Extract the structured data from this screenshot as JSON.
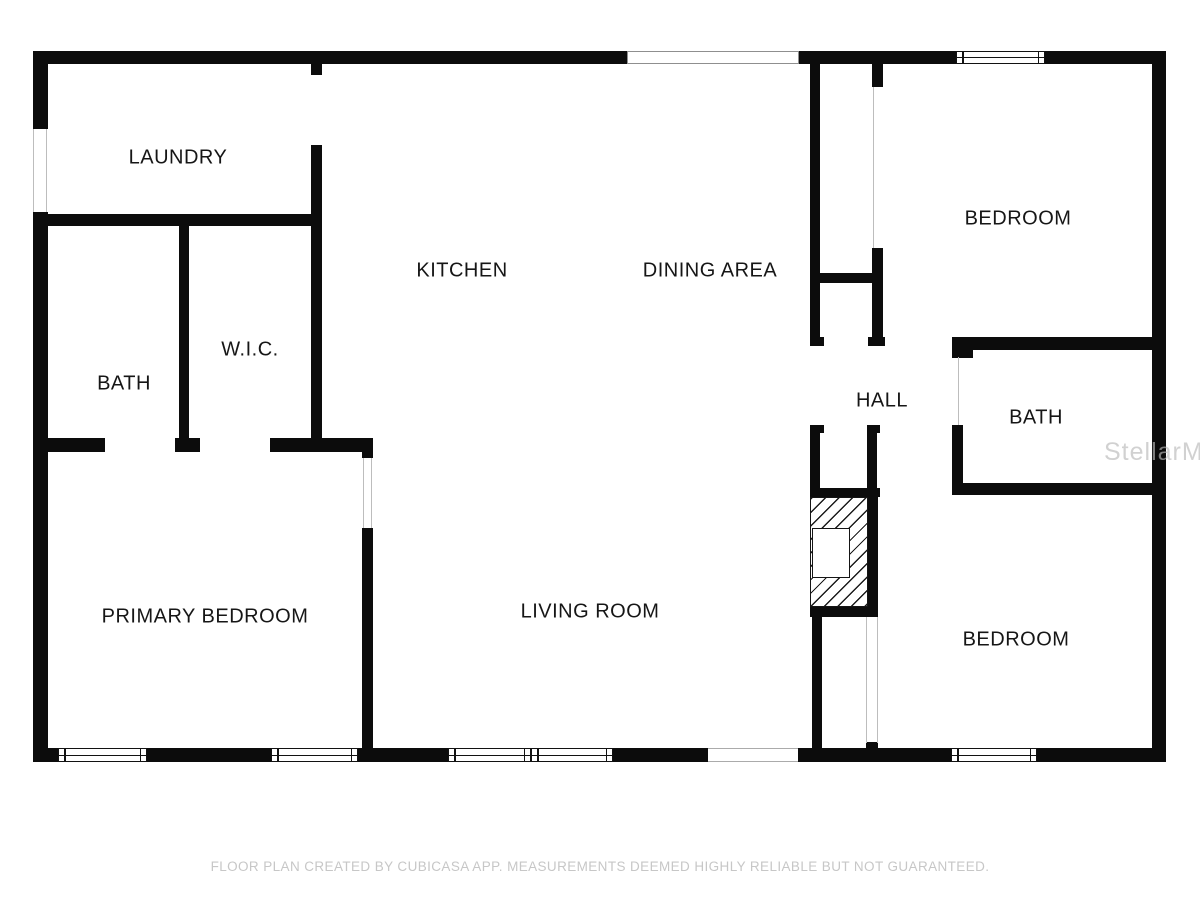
{
  "floorplan": {
    "canvas": {
      "width": 1200,
      "height": 900,
      "background": "#ffffff",
      "wall_color": "#0c0c0c"
    },
    "caption": {
      "text": "FLOOR PLAN CREATED BY CUBICASA APP. MEASUREMENTS DEEMED HIGHLY RELIABLE BUT NOT GUARANTEED.",
      "top": 859
    },
    "watermark": {
      "text": "StellarMLS",
      "left": 1104,
      "top": 438
    },
    "rooms": [
      {
        "id": "laundry",
        "label": "LAUNDRY",
        "x": 178,
        "y": 158
      },
      {
        "id": "kitchen",
        "label": "KITCHEN",
        "x": 462,
        "y": 271
      },
      {
        "id": "dining-area",
        "label": "DINING AREA",
        "x": 710,
        "y": 271
      },
      {
        "id": "bedroom-top",
        "label": "BEDROOM",
        "x": 1018,
        "y": 219
      },
      {
        "id": "bath-left",
        "label": "BATH",
        "x": 124,
        "y": 384
      },
      {
        "id": "wic",
        "label": "W.I.C.",
        "x": 250,
        "y": 350
      },
      {
        "id": "hall",
        "label": "HALL",
        "x": 882,
        "y": 401
      },
      {
        "id": "bath-right",
        "label": "BATH",
        "x": 1036,
        "y": 418
      },
      {
        "id": "primary-bedroom",
        "label": "PRIMARY BEDROOM",
        "x": 205,
        "y": 617
      },
      {
        "id": "living-room",
        "label": "LIVING ROOM",
        "x": 590,
        "y": 612
      },
      {
        "id": "bedroom-bottom",
        "label": "BEDROOM",
        "x": 1016,
        "y": 640
      }
    ],
    "walls": [
      {
        "id": "outer-top-left",
        "x": 33,
        "y": 51,
        "w": 594,
        "h": 13
      },
      {
        "id": "outer-top-right-a",
        "x": 799,
        "y": 51,
        "w": 157,
        "h": 13
      },
      {
        "id": "outer-top-right-b",
        "x": 1045,
        "y": 51,
        "w": 121,
        "h": 13
      },
      {
        "id": "outer-left-upper",
        "x": 33,
        "y": 51,
        "w": 15,
        "h": 78
      },
      {
        "id": "outer-left-lower",
        "x": 33,
        "y": 212,
        "w": 15,
        "h": 550
      },
      {
        "id": "outer-right",
        "x": 1152,
        "y": 51,
        "w": 14,
        "h": 711
      },
      {
        "id": "outer-bottom-1",
        "x": 33,
        "y": 748,
        "w": 25,
        "h": 14
      },
      {
        "id": "outer-bottom-2",
        "x": 147,
        "y": 748,
        "w": 124,
        "h": 14
      },
      {
        "id": "outer-bottom-3",
        "x": 358,
        "y": 748,
        "w": 90,
        "h": 14
      },
      {
        "id": "outer-bottom-4",
        "x": 613,
        "y": 748,
        "w": 95,
        "h": 14
      },
      {
        "id": "outer-bottom-5",
        "x": 798,
        "y": 748,
        "w": 153,
        "h": 14
      },
      {
        "id": "outer-bottom-6",
        "x": 1037,
        "y": 748,
        "w": 129,
        "h": 14
      },
      {
        "id": "laundry-right-upper",
        "x": 311,
        "y": 64,
        "w": 11,
        "h": 11
      },
      {
        "id": "laundry-wic-right",
        "x": 311,
        "y": 145,
        "w": 11,
        "h": 293
      },
      {
        "id": "laundry-bottom",
        "x": 33,
        "y": 214,
        "w": 288,
        "h": 12
      },
      {
        "id": "bath-wic-divider",
        "x": 179,
        "y": 226,
        "w": 10,
        "h": 214
      },
      {
        "id": "bathwic-bottom-left",
        "x": 33,
        "y": 438,
        "w": 72,
        "h": 14
      },
      {
        "id": "bathwic-bottom-mid",
        "x": 175,
        "y": 438,
        "w": 25,
        "h": 14
      },
      {
        "id": "bathwic-bottom-right",
        "x": 270,
        "y": 438,
        "w": 102,
        "h": 14
      },
      {
        "id": "lr-divider-stub",
        "x": 362,
        "y": 438,
        "w": 11,
        "h": 20
      },
      {
        "id": "lr-divider-main",
        "x": 362,
        "y": 528,
        "w": 11,
        "h": 220
      },
      {
        "id": "dining-hall-wall",
        "x": 810,
        "y": 64,
        "w": 10,
        "h": 282
      },
      {
        "id": "closet-divider",
        "x": 810,
        "y": 273,
        "w": 73,
        "h": 10
      },
      {
        "id": "closet-right-upper",
        "x": 872,
        "y": 64,
        "w": 11,
        "h": 23
      },
      {
        "id": "closet-right-lower",
        "x": 872,
        "y": 248,
        "w": 11,
        "h": 98
      },
      {
        "id": "closet-foot-left",
        "x": 810,
        "y": 337,
        "w": 14,
        "h": 9
      },
      {
        "id": "closet-foot-right",
        "x": 868,
        "y": 337,
        "w": 17,
        "h": 9
      },
      {
        "id": "bath2-top",
        "x": 952,
        "y": 337,
        "w": 214,
        "h": 13
      },
      {
        "id": "bath2-left-stub",
        "x": 952,
        "y": 350,
        "w": 21,
        "h": 8
      },
      {
        "id": "bath2-left",
        "x": 952,
        "y": 425,
        "w": 11,
        "h": 62
      },
      {
        "id": "bath2-bottom",
        "x": 952,
        "y": 483,
        "w": 214,
        "h": 12
      },
      {
        "id": "niche-left",
        "x": 810,
        "y": 425,
        "w": 10,
        "h": 67
      },
      {
        "id": "niche-left-foot",
        "x": 810,
        "y": 425,
        "w": 14,
        "h": 8
      },
      {
        "id": "niche-right",
        "x": 867,
        "y": 425,
        "w": 10,
        "h": 67
      },
      {
        "id": "niche-right-foot",
        "x": 867,
        "y": 425,
        "w": 13,
        "h": 8
      },
      {
        "id": "niche-bottom",
        "x": 810,
        "y": 488,
        "w": 70,
        "h": 9
      },
      {
        "id": "fireplace-right",
        "x": 868,
        "y": 497,
        "w": 10,
        "h": 110
      },
      {
        "id": "fireplace-bottom",
        "x": 810,
        "y": 607,
        "w": 68,
        "h": 10
      },
      {
        "id": "below-fireplace",
        "x": 812,
        "y": 617,
        "w": 10,
        "h": 131
      },
      {
        "id": "closet2-stub",
        "x": 866,
        "y": 742,
        "w": 12,
        "h": 6
      }
    ],
    "windows": [
      {
        "id": "window-top",
        "x": 956,
        "y": 51,
        "w": 89,
        "h": 13
      },
      {
        "id": "window-bottom-1",
        "x": 58,
        "y": 748,
        "w": 89,
        "h": 14
      },
      {
        "id": "window-bottom-2",
        "x": 271,
        "y": 748,
        "w": 87,
        "h": 14
      },
      {
        "id": "window-bottom-3",
        "x": 448,
        "y": 748,
        "w": 83,
        "h": 14
      },
      {
        "id": "window-bottom-4",
        "x": 531,
        "y": 748,
        "w": 82,
        "h": 14
      },
      {
        "id": "window-bottom-5",
        "x": 951,
        "y": 748,
        "w": 86,
        "h": 14
      }
    ],
    "openings": [
      {
        "id": "opening-top",
        "x": 627,
        "y": 51,
        "w": 172,
        "h": 13,
        "style": "outline"
      },
      {
        "id": "opening-bottom",
        "x": 708,
        "y": 748,
        "w": 90,
        "h": 14,
        "style": "hlines"
      }
    ],
    "opening_lines": [
      {
        "id": "left-door-jamb-a",
        "x": 33,
        "y": 129,
        "w": 1,
        "h": 83
      },
      {
        "id": "left-door-jamb-b",
        "x": 46,
        "y": 129,
        "w": 1,
        "h": 83
      },
      {
        "id": "closet-opening-line",
        "x": 873,
        "y": 87,
        "w": 1,
        "h": 161
      },
      {
        "id": "bath2-door-line",
        "x": 958,
        "y": 357,
        "w": 1,
        "h": 68
      },
      {
        "id": "closet2-line-a",
        "x": 866,
        "y": 617,
        "w": 1,
        "h": 126
      },
      {
        "id": "closet2-line-b",
        "x": 877,
        "y": 617,
        "w": 1,
        "h": 126
      },
      {
        "id": "primary-door-line-a",
        "x": 363,
        "y": 458,
        "w": 1,
        "h": 70
      },
      {
        "id": "primary-door-line-b",
        "x": 371,
        "y": 458,
        "w": 1,
        "h": 70
      }
    ],
    "fireplace": {
      "x": 810,
      "y": 497,
      "w": 58,
      "h": 110,
      "firebox": {
        "x": 1,
        "y": 30,
        "w": 38,
        "h": 50
      }
    }
  }
}
